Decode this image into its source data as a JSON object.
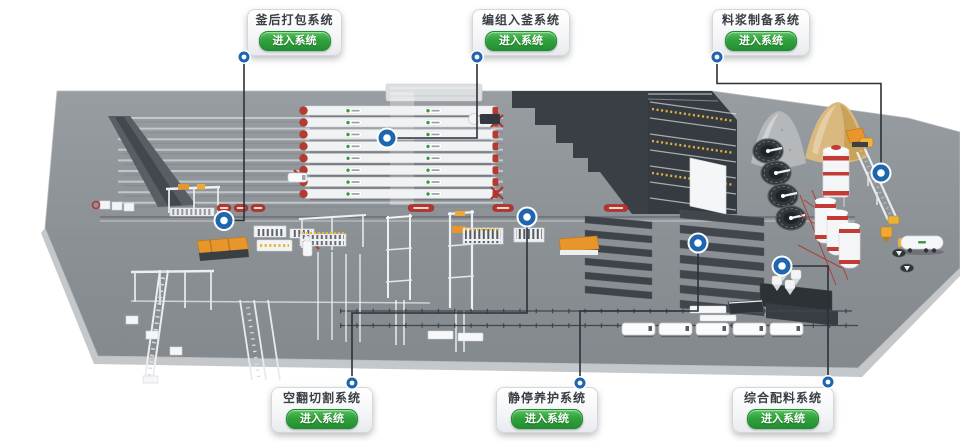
{
  "app": {
    "background": "#ffffff"
  },
  "palette": {
    "marker_blue": "#1e66ad",
    "leader_line": "#2b3138",
    "card_text": "#3a3f44",
    "button_green": "#2fa23b",
    "platform_gray": "#8a8f94",
    "autoclave_red": "#b23c31",
    "banner_red": "#b5342c",
    "machine_orange": "#e8952b",
    "sand_tan": "#d9b97e",
    "pile_gray": "#b5b8ba",
    "dark_building": "#3a3f45"
  },
  "callouts": [
    {
      "id": "aft-autoclave-packing",
      "title": "釜后打包系统",
      "button_label": "进入系统",
      "card": {
        "x": 247,
        "y": 9,
        "w": 95,
        "h": 47
      },
      "dot": {
        "x": 244,
        "y": 57
      },
      "path": "M244,57 L244,220.5 L224,220.5",
      "marker": {
        "x": 224,
        "y": 220.5
      }
    },
    {
      "id": "grouping-into-autoclave",
      "title": "编组入釜系统",
      "button_label": "进入系统",
      "card": {
        "x": 472,
        "y": 9,
        "w": 98,
        "h": 47
      },
      "dot": {
        "x": 477,
        "y": 57
      },
      "path": "M477,57 L477,138 L387,138",
      "marker": {
        "x": 387,
        "y": 138
      }
    },
    {
      "id": "slurry-preparation",
      "title": "料浆制备系统",
      "button_label": "进入系统",
      "card": {
        "x": 712,
        "y": 9,
        "w": 98,
        "h": 47
      },
      "dot": {
        "x": 717,
        "y": 57
      },
      "path": "M717,57 L717,83.5 L881,83.5 L881,173",
      "marker": {
        "x": 881,
        "y": 173
      }
    },
    {
      "id": "tilting-cutting",
      "title": "空翻切割系统",
      "button_label": "进入系统",
      "card": {
        "x": 271,
        "y": 387,
        "w": 102,
        "h": 46
      },
      "dot": {
        "x": 352,
        "y": 383
      },
      "path": "M352,383 L352,313 L527,313 L527,217",
      "marker": {
        "x": 527,
        "y": 217
      }
    },
    {
      "id": "pre-curing",
      "title": "静停养护系统",
      "button_label": "进入系统",
      "card": {
        "x": 496,
        "y": 387,
        "w": 102,
        "h": 46
      },
      "dot": {
        "x": 580,
        "y": 383
      },
      "path": "M580,383 L580,311 L698,311 L698,243",
      "marker": {
        "x": 698,
        "y": 243
      }
    },
    {
      "id": "integrated-batching",
      "title": "综合配料系统",
      "button_label": "进入系统",
      "card": {
        "x": 732,
        "y": 387,
        "w": 102,
        "h": 46
      },
      "dot": {
        "x": 828,
        "y": 382
      },
      "path": "M828,382 L828,266 L782,266",
      "marker": {
        "x": 782,
        "y": 266
      }
    }
  ],
  "scene": {
    "conveyor_lines": {
      "x1": 118,
      "x2": 503,
      "y0": 118,
      "pitch": 10.6,
      "count": 9
    },
    "autoclaves": {
      "x": 302,
      "w": 197,
      "y0": 106,
      "pitch": 11.9,
      "count": 8,
      "body": "#f0f2f4",
      "cap": "#b23c31"
    },
    "chambers": [
      {
        "x1": 585,
        "x2": 652,
        "y0": 216,
        "pitch": 14,
        "count": 6,
        "slant": 6,
        "thick": 7,
        "fill": "#3e434a"
      },
      {
        "x1": 680,
        "x2": 764,
        "y0": 210,
        "pitch": 15,
        "count": 7,
        "slant": 8,
        "thick": 8,
        "fill": "#41464d"
      }
    ],
    "pools": {
      "centers": [
        [
          768,
          151
        ],
        [
          776,
          173
        ],
        [
          783,
          196
        ],
        [
          791,
          218
        ]
      ],
      "rx": 15,
      "ry": 12
    },
    "trucks": {
      "y": 323,
      "w": 33,
      "h": 12,
      "xs": [
        622,
        659,
        696,
        733,
        770
      ]
    },
    "banners": {
      "y": 208,
      "items": [
        [
          224,
          14
        ],
        [
          241,
          14
        ],
        [
          258,
          14
        ],
        [
          421,
          26
        ],
        [
          503,
          21
        ],
        [
          616,
          24
        ]
      ]
    },
    "tracks": [
      {
        "x1": 340,
        "x2": 852,
        "y": 311
      },
      {
        "x1": 340,
        "x2": 858,
        "y": 325.5
      }
    ]
  }
}
